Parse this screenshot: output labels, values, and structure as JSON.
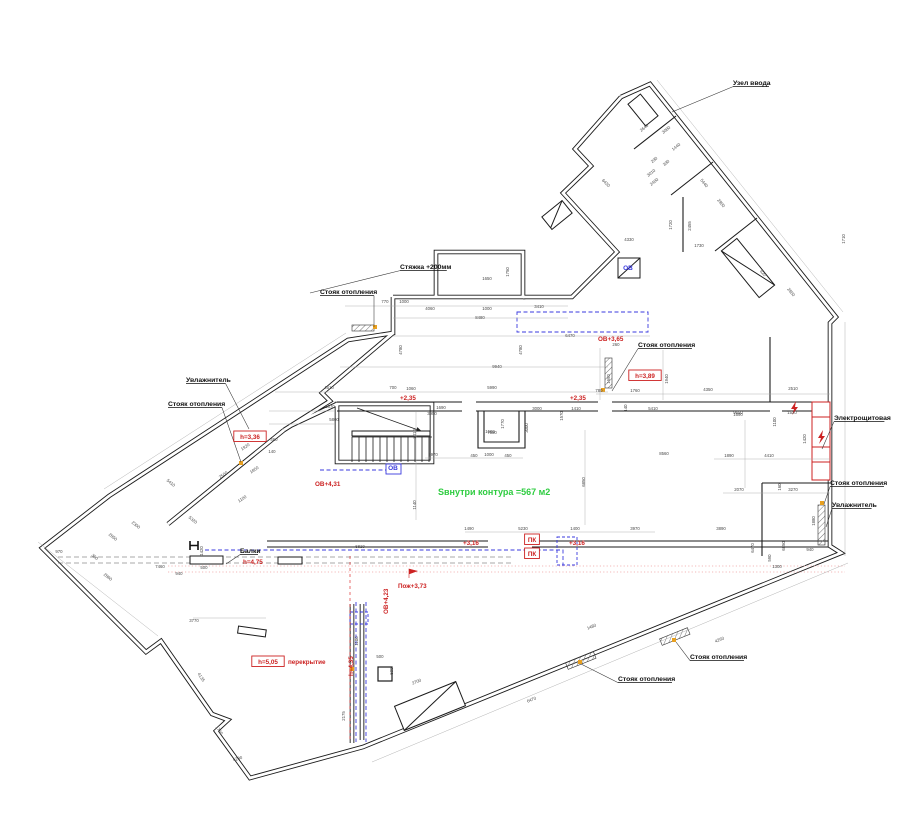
{
  "meta": {
    "drawing_kind": "floor plan with HVAC / heating annotations"
  },
  "colors": {
    "wall": "#1b1b1b",
    "dim": "#4a4a4a",
    "red": "#cc2222",
    "blue": "#3a3adf",
    "green": "#2ecc40",
    "pink": "#f0a3a3",
    "orange": "#e8a020",
    "gray": "#9a9a9a"
  },
  "area_note": {
    "text": "Sвнутри контура =567 м2",
    "x": 438,
    "y": 495
  },
  "callouts": [
    {
      "label": "Узел ввода",
      "x": 733,
      "y": 85,
      "tx": 672,
      "ty": 112
    },
    {
      "label": "Стяжка +200мм",
      "x": 400,
      "y": 269,
      "tx": 310,
      "ty": 293
    },
    {
      "label": "Стояк отопления",
      "x": 320,
      "y": 294,
      "tx": 374,
      "ty": 327
    },
    {
      "label": "Увлажнитель",
      "x": 186,
      "y": 382,
      "tx": 249,
      "ty": 429
    },
    {
      "label": "Стояк отопления",
      "x": 168,
      "y": 406,
      "tx": 241,
      "ty": 462
    },
    {
      "label": "Стояк отопления",
      "x": 638,
      "y": 347,
      "tx": 612,
      "ty": 391
    },
    {
      "label": "Электрощитовая",
      "x": 834,
      "y": 420,
      "tx": 822,
      "ty": 449
    },
    {
      "label": "Стояк отопления",
      "x": 830,
      "y": 485,
      "tx": 824,
      "ty": 504
    },
    {
      "label": "Увлажнитель",
      "x": 832,
      "y": 507,
      "tx": 826,
      "ty": 527
    },
    {
      "label": "Стояк отопления",
      "x": 618,
      "y": 681,
      "tx": 581,
      "ty": 664
    },
    {
      "label": "Стояк отопления",
      "x": 690,
      "y": 659,
      "tx": 676,
      "ty": 642
    },
    {
      "label": "Балки",
      "x": 240,
      "y": 553,
      "tx": 226,
      "ty": 564
    }
  ],
  "level_marks": [
    {
      "text": "+2,35",
      "x": 400,
      "y": 400
    },
    {
      "text": "+2,35",
      "x": 570,
      "y": 400
    },
    {
      "text": "+3,16",
      "x": 463,
      "y": 545
    },
    {
      "text": "+3,16",
      "x": 569,
      "y": 545
    },
    {
      "text": "ОВ+3,65",
      "x": 598,
      "y": 341
    },
    {
      "text": "ОВ+4,31",
      "x": 315,
      "y": 486
    },
    {
      "text": "ОВ+4,23",
      "x": 388,
      "y": 614,
      "r": -90
    },
    {
      "text": "h=4,35",
      "x": 353,
      "y": 676,
      "r": -90
    },
    {
      "text": "Пож+3,73",
      "x": 398,
      "y": 588
    },
    {
      "text": "h=4,75",
      "x": 243,
      "y": 564
    },
    {
      "text": "h=3,36",
      "x": 250,
      "y": 439,
      "boxed": true
    },
    {
      "text": "h=3,89",
      "x": 645,
      "y": 378,
      "boxed": true
    },
    {
      "text": "h=5,05",
      "x": 268,
      "y": 664,
      "boxed": true
    },
    {
      "text": "перекрытие",
      "x": 288,
      "y": 664
    },
    {
      "text": "ПК",
      "x": 532,
      "y": 542,
      "boxed": true
    },
    {
      "text": "ПК",
      "x": 532,
      "y": 556,
      "boxed": true
    }
  ],
  "duct_labels": [
    {
      "text": "ОВ",
      "x": 628,
      "y": 270
    },
    {
      "text": "ОВ",
      "x": 393,
      "y": 470
    }
  ],
  "dimensions": [
    {
      "t": "1650",
      "x": 487,
      "y": 280
    },
    {
      "t": "1750",
      "x": 509,
      "y": 272,
      "r": -90
    },
    {
      "t": "770",
      "x": 385,
      "y": 303
    },
    {
      "t": "1000",
      "x": 404,
      "y": 303
    },
    {
      "t": "4060",
      "x": 430,
      "y": 310
    },
    {
      "t": "1000",
      "x": 487,
      "y": 310
    },
    {
      "t": "3410",
      "x": 539,
      "y": 308
    },
    {
      "t": "8480",
      "x": 480,
      "y": 319
    },
    {
      "t": "6470",
      "x": 570,
      "y": 337
    },
    {
      "t": "4780",
      "x": 402,
      "y": 350,
      "r": -90
    },
    {
      "t": "4780",
      "x": 522,
      "y": 350,
      "r": -90
    },
    {
      "t": "9940",
      "x": 497,
      "y": 368
    },
    {
      "t": "5990",
      "x": 492,
      "y": 389
    },
    {
      "t": "4510",
      "x": 329,
      "y": 389
    },
    {
      "t": "700",
      "x": 393,
      "y": 389
    },
    {
      "t": "1060",
      "x": 411,
      "y": 390
    },
    {
      "t": "5670",
      "x": 330,
      "y": 408
    },
    {
      "t": "5800",
      "x": 334,
      "y": 421
    },
    {
      "t": "460",
      "x": 274,
      "y": 441
    },
    {
      "t": "140",
      "x": 272,
      "y": 453
    },
    {
      "t": "2970",
      "x": 433,
      "y": 456
    },
    {
      "t": "450",
      "x": 474,
      "y": 457
    },
    {
      "t": "1000",
      "x": 489,
      "y": 456
    },
    {
      "t": "450",
      "x": 508,
      "y": 457
    },
    {
      "t": "7580",
      "x": 492,
      "y": 434
    },
    {
      "t": "1690",
      "x": 441,
      "y": 409
    },
    {
      "t": "3950",
      "x": 432,
      "y": 415
    },
    {
      "t": "1580",
      "x": 490,
      "y": 433
    },
    {
      "t": "1770",
      "x": 504,
      "y": 424,
      "r": -90
    },
    {
      "t": "3000",
      "x": 537,
      "y": 410
    },
    {
      "t": "3000",
      "x": 528,
      "y": 428,
      "r": -90
    },
    {
      "t": "1570",
      "x": 563,
      "y": 416,
      "r": -90
    },
    {
      "t": "1410",
      "x": 576,
      "y": 410
    },
    {
      "t": "8560",
      "x": 664,
      "y": 455
    },
    {
      "t": "6850",
      "x": 585,
      "y": 482,
      "r": -90
    },
    {
      "t": "3010",
      "x": 416,
      "y": 434,
      "r": -90
    },
    {
      "t": "1140",
      "x": 416,
      "y": 505,
      "r": -90
    },
    {
      "t": "1490",
      "x": 469,
      "y": 530
    },
    {
      "t": "5230",
      "x": 523,
      "y": 530
    },
    {
      "t": "1400",
      "x": 575,
      "y": 530
    },
    {
      "t": "3970",
      "x": 635,
      "y": 530
    },
    {
      "t": "6810",
      "x": 360,
      "y": 548
    },
    {
      "t": "260",
      "x": 616,
      "y": 346
    },
    {
      "t": "780",
      "x": 599,
      "y": 392
    },
    {
      "t": "1760",
      "x": 635,
      "y": 392
    },
    {
      "t": "4350",
      "x": 708,
      "y": 391
    },
    {
      "t": "5410",
      "x": 653,
      "y": 410
    },
    {
      "t": "140",
      "x": 627,
      "y": 408,
      "r": -90
    },
    {
      "t": "1690",
      "x": 610,
      "y": 379,
      "r": -90
    },
    {
      "t": "1940",
      "x": 668,
      "y": 379,
      "r": -90
    },
    {
      "t": "9650",
      "x": 738,
      "y": 414
    },
    {
      "t": "2510",
      "x": 793,
      "y": 390
    },
    {
      "t": "1690",
      "x": 738,
      "y": 416
    },
    {
      "t": "1100",
      "x": 776,
      "y": 422,
      "r": -90
    },
    {
      "t": "1520",
      "x": 792,
      "y": 414
    },
    {
      "t": "1420",
      "x": 806,
      "y": 439,
      "r": -90
    },
    {
      "t": "4410",
      "x": 769,
      "y": 457
    },
    {
      "t": "1890",
      "x": 729,
      "y": 457
    },
    {
      "t": "2070",
      "x": 739,
      "y": 491
    },
    {
      "t": "3270",
      "x": 793,
      "y": 491
    },
    {
      "t": "160",
      "x": 781,
      "y": 487,
      "r": -90
    },
    {
      "t": "3890",
      "x": 721,
      "y": 530
    },
    {
      "t": "1880",
      "x": 815,
      "y": 521,
      "r": -90
    },
    {
      "t": "940",
      "x": 810,
      "y": 551
    },
    {
      "t": "6850",
      "x": 785,
      "y": 546,
      "r": -90
    },
    {
      "t": "590",
      "x": 771,
      "y": 558,
      "r": -90
    },
    {
      "t": "1300",
      "x": 777,
      "y": 568
    },
    {
      "t": "6470",
      "x": 754,
      "y": 548,
      "r": -90
    },
    {
      "t": "1480",
      "x": 592,
      "y": 628,
      "r": -22
    },
    {
      "t": "4260",
      "x": 720,
      "y": 641,
      "r": -22
    },
    {
      "t": "6470",
      "x": 532,
      "y": 701,
      "r": -22
    },
    {
      "t": "2700",
      "x": 417,
      "y": 683,
      "r": -22
    },
    {
      "t": "500",
      "x": 380,
      "y": 658
    },
    {
      "t": "500",
      "x": 393,
      "y": 671,
      "r": -90
    },
    {
      "t": "1100",
      "x": 358,
      "y": 641,
      "r": -90
    },
    {
      "t": "3770",
      "x": 194,
      "y": 622
    },
    {
      "t": "4135",
      "x": 200,
      "y": 678,
      "r": 56
    },
    {
      "t": "1720",
      "x": 218,
      "y": 731,
      "r": 56
    },
    {
      "t": "5230",
      "x": 238,
      "y": 760,
      "r": -15
    },
    {
      "t": "2175",
      "x": 345,
      "y": 716,
      "r": -90
    },
    {
      "t": "2500",
      "x": 224,
      "y": 476,
      "r": -34
    },
    {
      "t": "1920",
      "x": 246,
      "y": 448,
      "r": -34
    },
    {
      "t": "1850",
      "x": 255,
      "y": 471,
      "r": -34
    },
    {
      "t": "1100",
      "x": 243,
      "y": 500,
      "r": -34
    },
    {
      "t": "2860",
      "x": 107,
      "y": 578,
      "r": 38
    },
    {
      "t": "5320",
      "x": 192,
      "y": 521,
      "r": 38
    },
    {
      "t": "5410",
      "x": 170,
      "y": 484,
      "r": 38
    },
    {
      "t": "7460",
      "x": 160,
      "y": 568
    },
    {
      "t": "940",
      "x": 179,
      "y": 575
    },
    {
      "t": "500",
      "x": 204,
      "y": 569
    },
    {
      "t": "1420",
      "x": 203,
      "y": 551,
      "r": -90
    },
    {
      "t": "970",
      "x": 59,
      "y": 553
    },
    {
      "t": "300",
      "x": 94,
      "y": 558,
      "r": 38
    },
    {
      "t": "2300",
      "x": 135,
      "y": 526,
      "r": 38
    },
    {
      "t": "2850",
      "x": 112,
      "y": 538,
      "r": 38
    },
    {
      "t": "2640",
      "x": 645,
      "y": 129,
      "r": -39
    },
    {
      "t": "3080",
      "x": 667,
      "y": 131,
      "r": -39
    },
    {
      "t": "1440",
      "x": 677,
      "y": 148,
      "r": -39
    },
    {
      "t": "290",
      "x": 655,
      "y": 161,
      "r": -39
    },
    {
      "t": "390",
      "x": 667,
      "y": 164,
      "r": -39
    },
    {
      "t": "3010",
      "x": 652,
      "y": 174,
      "r": -39
    },
    {
      "t": "2400",
      "x": 655,
      "y": 183,
      "r": -39
    },
    {
      "t": "6430",
      "x": 605,
      "y": 184,
      "r": 45
    },
    {
      "t": "2900",
      "x": 720,
      "y": 204,
      "r": 51
    },
    {
      "t": "5440",
      "x": 703,
      "y": 184,
      "r": 51
    },
    {
      "t": "1730",
      "x": 699,
      "y": 247
    },
    {
      "t": "1720",
      "x": 672,
      "y": 225,
      "r": -90
    },
    {
      "t": "2455",
      "x": 691,
      "y": 226,
      "r": -90
    },
    {
      "t": "4330",
      "x": 629,
      "y": 241
    },
    {
      "t": "820",
      "x": 762,
      "y": 274,
      "r": 51
    },
    {
      "t": "2850",
      "x": 790,
      "y": 293,
      "r": 51
    },
    {
      "t": "1710",
      "x": 845,
      "y": 239,
      "r": -90
    }
  ]
}
